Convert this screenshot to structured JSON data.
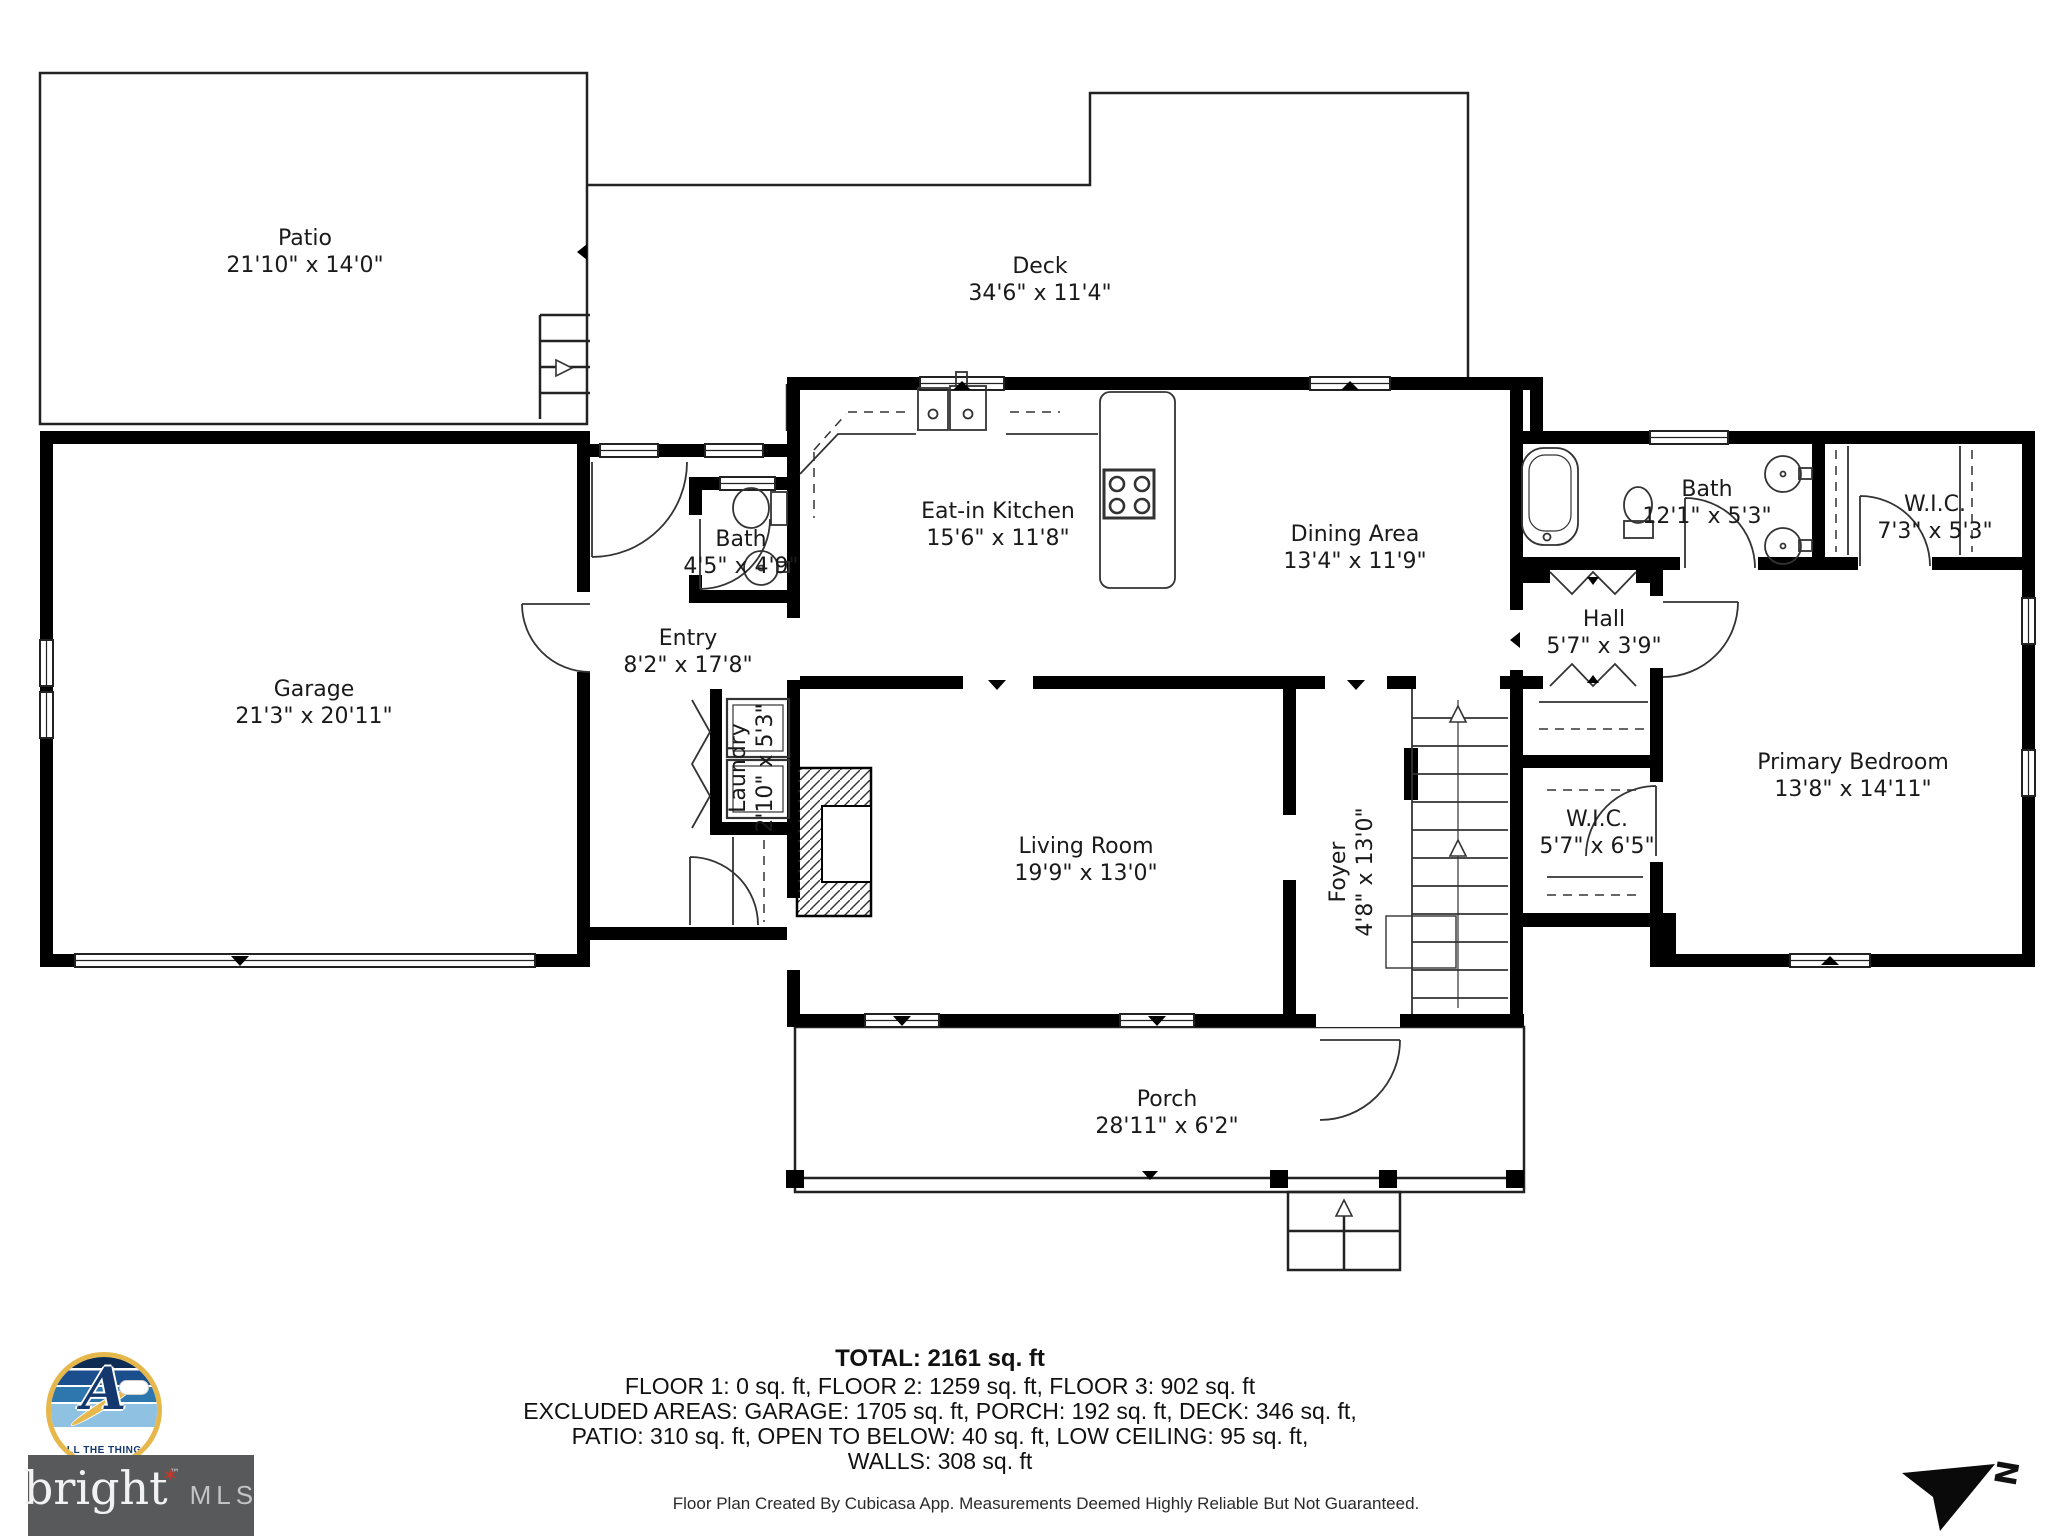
{
  "rooms": {
    "patio": {
      "name": "Patio",
      "dims": "21'10\" x 14'0\""
    },
    "deck": {
      "name": "Deck",
      "dims": "34'6\" x 11'4\""
    },
    "garage": {
      "name": "Garage",
      "dims": "21'3\" x 20'11\""
    },
    "bath_small": {
      "name": "Bath",
      "dims": "4'5\" x 4'9\""
    },
    "kitchen": {
      "name": "Eat-in Kitchen",
      "dims": "15'6\" x 11'8\""
    },
    "dining": {
      "name": "Dining Area",
      "dims": "13'4\" x 11'9\""
    },
    "bath_right": {
      "name": "Bath",
      "dims": "12'1\" x 5'3\""
    },
    "wic_right": {
      "name": "W.I.C.",
      "dims": "7'3\" x 5'3\""
    },
    "entry": {
      "name": "Entry",
      "dims": "8'2\" x 17'8\""
    },
    "hall": {
      "name": "Hall",
      "dims": "5'7\" x 3'9\""
    },
    "laundry": {
      "name": "Laundry",
      "dims": "2'10\" x 5'3\""
    },
    "living": {
      "name": "Living Room",
      "dims": "19'9\" x 13'0\""
    },
    "foyer": {
      "name": "Foyer",
      "dims": "4'8\" x 13'0\""
    },
    "wic_mid": {
      "name": "W.I.C.",
      "dims": "5'7\" x 6'5\""
    },
    "primary_bedroom": {
      "name": "Primary Bedroom",
      "dims": "13'8\" x 14'11\""
    },
    "porch": {
      "name": "Porch",
      "dims": "28'11\" x 6'2\""
    }
  },
  "summary": {
    "total": "TOTAL: 2161 sq. ft",
    "line1": "FLOOR 1: 0 sq. ft, FLOOR 2: 1259 sq. ft, FLOOR 3: 902 sq. ft",
    "line2": "EXCLUDED AREAS: GARAGE: 1705 sq. ft, PORCH: 192 sq. ft, DECK: 346 sq. ft,",
    "line3": "PATIO: 310 sq. ft, OPEN TO BELOW: 40 sq. ft, LOW CEILING: 95 sq. ft,",
    "line4": "WALLS: 308 sq. ft"
  },
  "footer": {
    "disclaimer": "Floor Plan Created By Cubicasa App. Measurements Deemed Highly Reliable But Not Guaranteed."
  },
  "branding": {
    "badge_text": "ALL THE THINGS",
    "badge_letter": "A",
    "mls_name": "bright",
    "mls_star": "✶",
    "mls_tm": "™",
    "mls_suffix": "MLS",
    "colors": {
      "wall": "#000000",
      "badge_gold": "#E6B84C",
      "badge_navy": "#14386E",
      "mls_bg": "#58595B",
      "star_red": "#C0392B"
    }
  },
  "compass": {
    "label": "N"
  }
}
